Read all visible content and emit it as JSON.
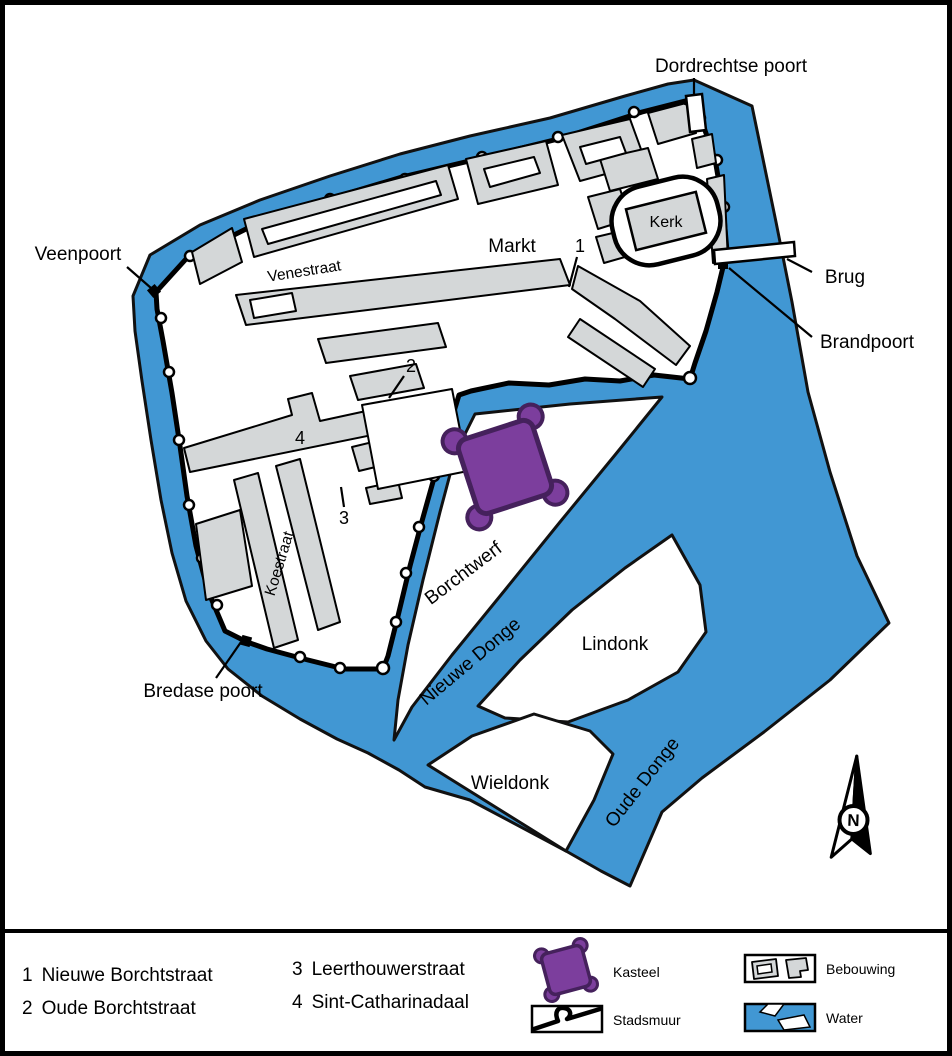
{
  "map": {
    "labels": {
      "dordrechtse_poort": "Dordrechtse poort",
      "veenpoort": "Veenpoort",
      "brug": "Brug",
      "brandpoort": "Brandpoort",
      "bredase_poort": "Bredase poort",
      "markt": "Markt",
      "kerk": "Kerk",
      "venestraat": "Venestraat",
      "koestraat": "Koestraat",
      "borchtwerf": "Borchtwerf",
      "nieuwe_donge": "Nieuwe Donge",
      "lindonk": "Lindonk",
      "oude_donge": "Oude Donge",
      "wieldonk": "Wieldonk"
    },
    "markers": {
      "n1": "1",
      "n2": "2",
      "n3": "3",
      "n4": "4"
    },
    "compass_label": "N"
  },
  "legend": {
    "streets": [
      {
        "num": "1",
        "name": "Nieuwe Borchtstraat"
      },
      {
        "num": "2",
        "name": "Oude Borchtstraat"
      },
      {
        "num": "3",
        "name": "Leerthouwerstraat"
      },
      {
        "num": "4",
        "name": "Sint-Catharinadaal"
      }
    ],
    "symbols": [
      {
        "label": "Kasteel"
      },
      {
        "label": "Stadsmuur"
      },
      {
        "label": "Bebouwing"
      },
      {
        "label": "Water"
      }
    ]
  },
  "colors": {
    "water": "#4197D3",
    "building": "#D4D7D8",
    "castle": "#7C3E9D",
    "castle_outline": "#45215C",
    "ink": "#000000",
    "background": "#FFFFFF"
  }
}
